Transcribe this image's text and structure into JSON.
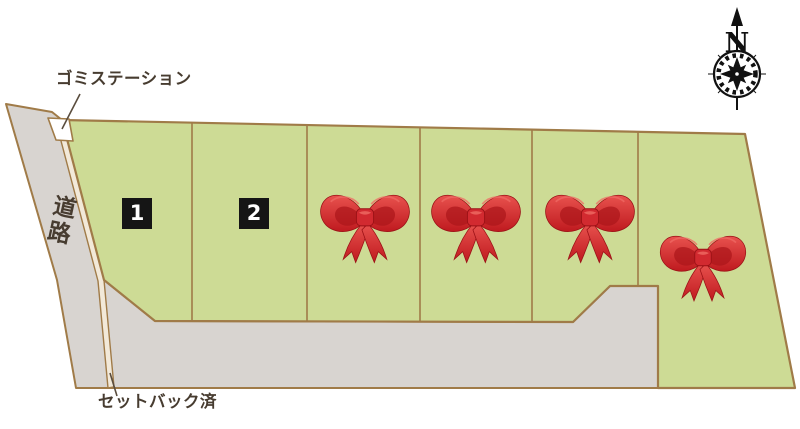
{
  "map": {
    "labels": {
      "garbage_station": "ゴミステーション",
      "road": "道路",
      "setback_done": "セットバック済",
      "compass_north": "N"
    },
    "lots": [
      {
        "number": "1",
        "status": "available"
      },
      {
        "number": "2",
        "status": "available"
      },
      {
        "number": "",
        "status": "sold",
        "marker": "red-ribbon"
      },
      {
        "number": "",
        "status": "sold",
        "marker": "red-ribbon"
      },
      {
        "number": "",
        "status": "sold",
        "marker": "red-ribbon"
      },
      {
        "number": "",
        "status": "sold",
        "marker": "red-ribbon"
      }
    ],
    "colors": {
      "lot_green": "#cddb95",
      "road_gray": "#d8d4d0",
      "border_tan": "#a07b48",
      "setback_cream": "#f2e9d9",
      "ribbon_red": "#d2232a",
      "badge_black": "#151515",
      "label_text": "#473c30"
    }
  }
}
